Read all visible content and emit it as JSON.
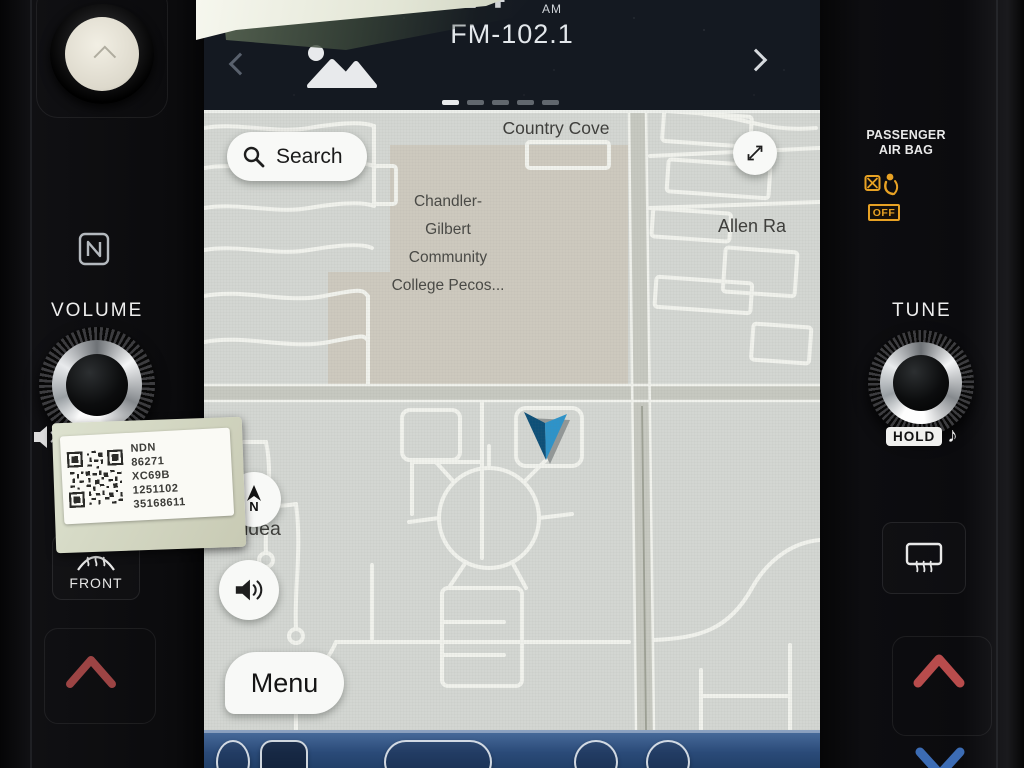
{
  "colors": {
    "map-bg": "#d3d6d2",
    "map-road": "#f1f2ed",
    "map-road-major": "#c6c8c0",
    "map-campus": "#cdc9be",
    "accent-blue": "#2e93c9",
    "bar-blue": "#2f5183",
    "screen-dark": "#141921",
    "bezel": "#0c0c0e",
    "warn-orange": "#e8a224",
    "chev-red": "#9c4444",
    "chev-red-bright": "#b84c4c",
    "chev-blue": "#3c6cb4"
  },
  "media": {
    "time_digits": "24",
    "time_suffix": "AM",
    "station": "FM-102.1"
  },
  "map_ui": {
    "search_label": "Search",
    "menu_label": "Menu",
    "compass_letter": "N",
    "street_top": "Country Cove",
    "street_right": "Allen Ra",
    "street_left": "os Aldea",
    "poi_lines": [
      "Chandler-",
      "Gilbert",
      "Community",
      "College Pecos..."
    ]
  },
  "left_bezel": {
    "volume_label": "VOLUME",
    "front_label": "FRONT"
  },
  "right_bezel": {
    "airbag_line1": "PASSENGER",
    "airbag_line2": "AIR BAG",
    "airbag_off": "OFF",
    "tune_label": "TUNE",
    "hold_label": "HOLD",
    "note_glyph": "♪"
  },
  "service_sticker": {
    "lines": [
      "NDN",
      "86271",
      "XC69B",
      "1251102",
      "35168611"
    ]
  }
}
